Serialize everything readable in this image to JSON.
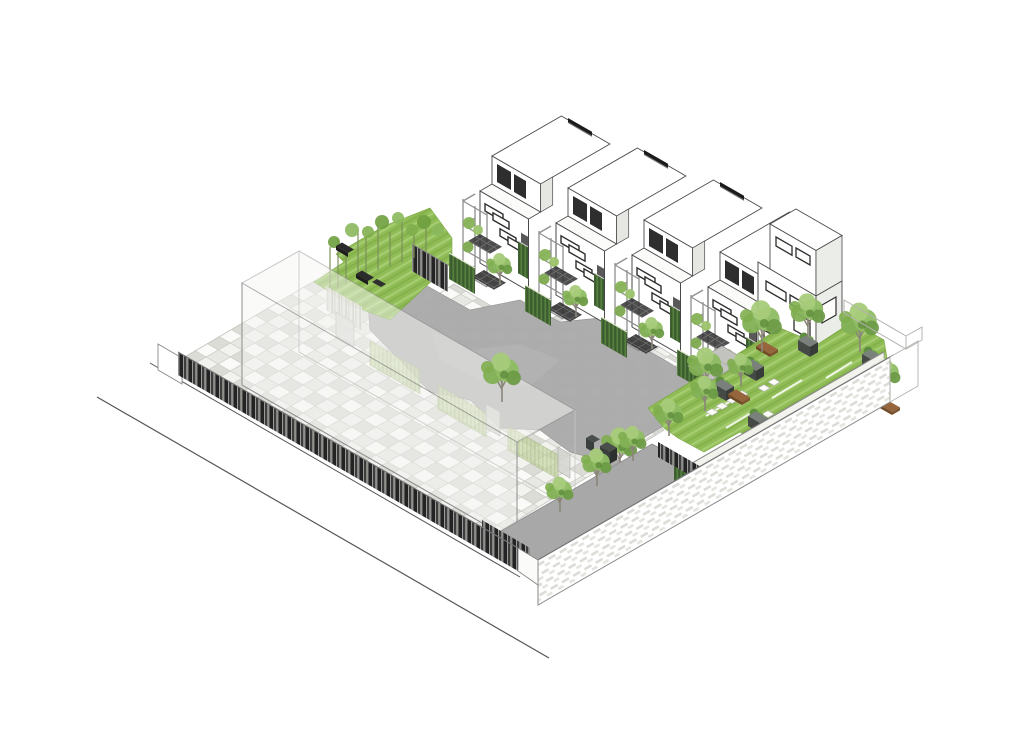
{
  "scene": {
    "type": "architectural axonometric site rendering",
    "background": "#ffffff",
    "projection": "isometric 30-degree",
    "content": "row of townhouses with courtyard, ghost building volume, perimeter fence, garden terraces and tree-lined walkway"
  },
  "colors": {
    "street": "#555555",
    "fence": "#232323",
    "paving": "#e7e7e3",
    "path": "#ababab",
    "walkway": "#a8a8a8",
    "lawn": "#8fbc55",
    "lawn_stripe": "#a5cc70",
    "canopy": "#8fbd63",
    "canopy_dark": "#5e8c3c",
    "hedge": "#4b7039",
    "hedge_ghost": "#c3d4a0",
    "solar": "#1b1b1b",
    "window": "#2e2e2e",
    "frame": "#8f8f8f",
    "bench": "#96653c",
    "planter": "#454a47",
    "wall_hatch": "#dcdcd7",
    "outline": "#4a4a4a",
    "ghost_volume": "#f6f6f4"
  },
  "elements": {
    "townhouse_units": 4,
    "right_wing_house": 1,
    "ghost_volume": 1,
    "rooftop_solar_bars": 4,
    "street_edge_lines": 2,
    "courtyard_trees": 3,
    "yard_trees": 4,
    "walkway_trees": 6,
    "garden_trees": 5,
    "garden_benches": 4,
    "garden_planters": 6,
    "ghost_hedge_screens": 3,
    "front_hedge_screens": 4,
    "green_pillars": 2,
    "bamboo_stems": 10
  }
}
